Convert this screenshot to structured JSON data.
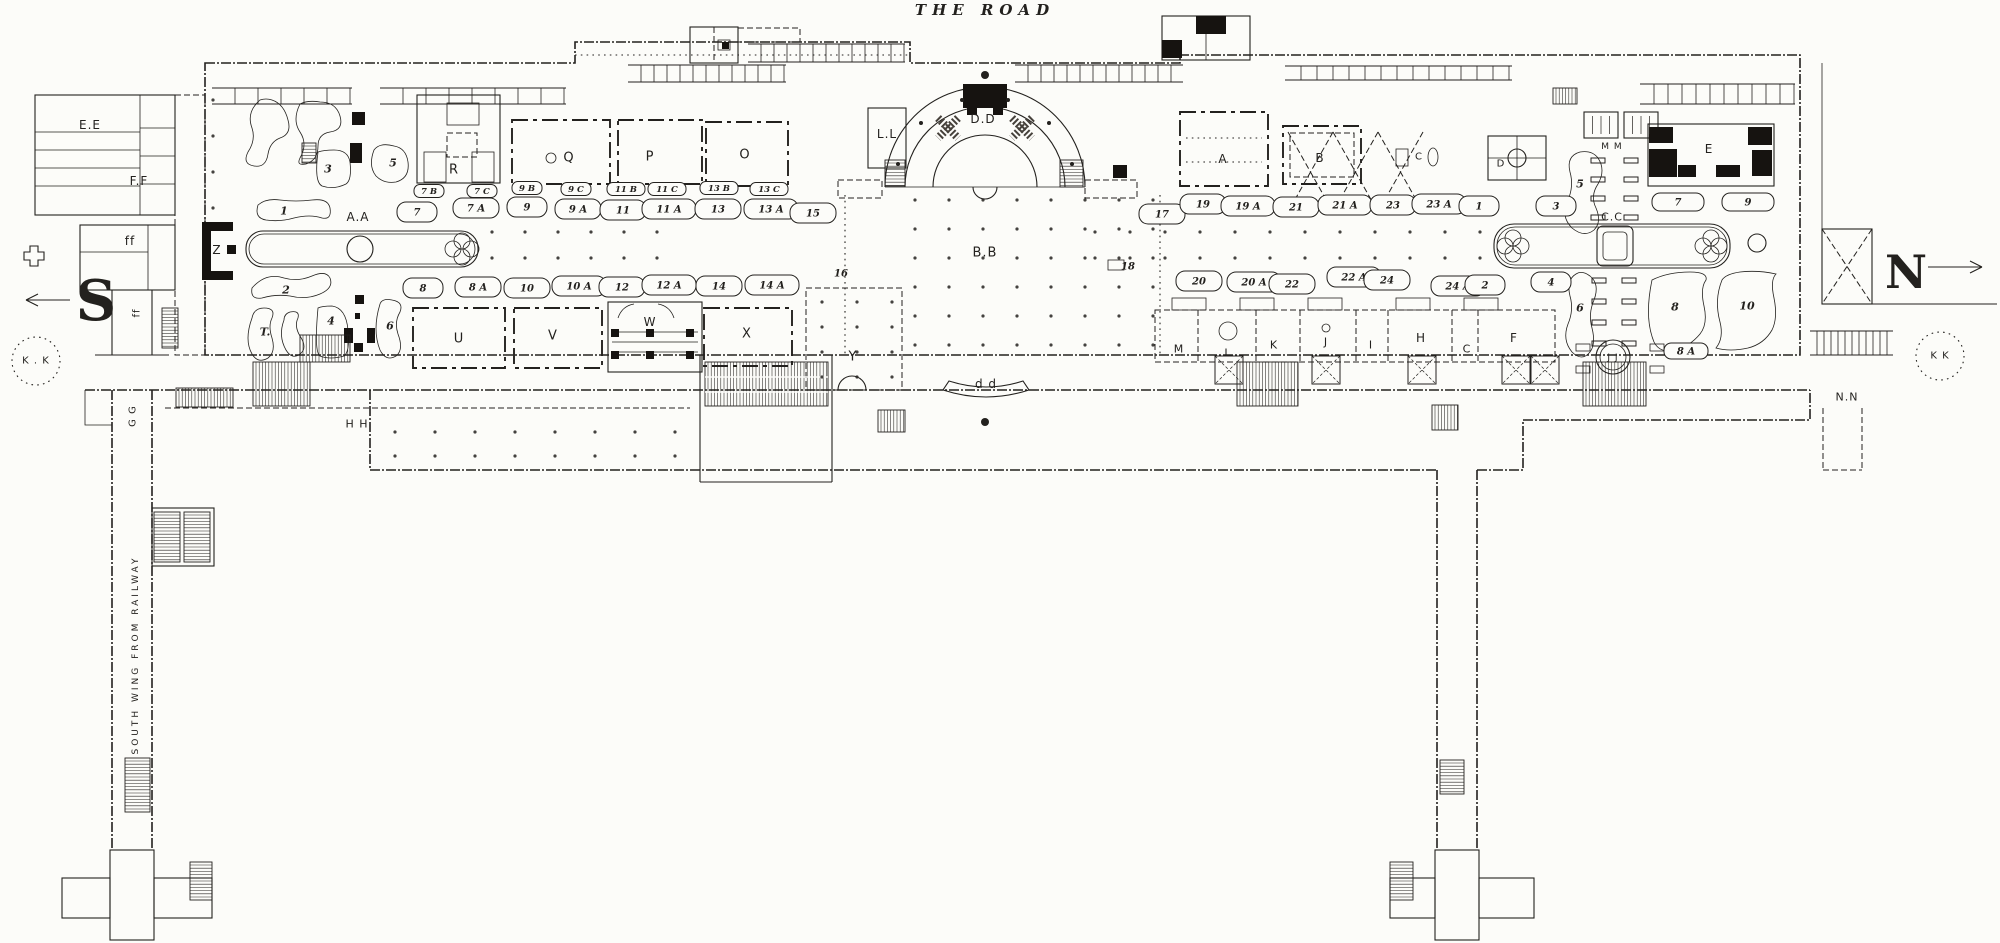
{
  "colors": {
    "paper": "#fcfcf9",
    "ink": "#23211e"
  },
  "plan_labels": [
    {
      "id": "road-title",
      "t": "THE ROAD",
      "x": 985,
      "y": 10,
      "fs": 15,
      "cls": "title"
    },
    {
      "id": "south-s",
      "t": "S",
      "x": 96,
      "y": 301,
      "fs": 56,
      "cls": "big"
    },
    {
      "id": "north-n",
      "t": "N",
      "x": 1906,
      "y": 272,
      "fs": 46,
      "cls": "big"
    },
    {
      "id": "ee",
      "t": "E.E",
      "x": 90,
      "y": 125,
      "fs": 12,
      "cls": "sans"
    },
    {
      "id": "ff-upper",
      "t": "F.F",
      "x": 139,
      "y": 181,
      "fs": 12,
      "cls": "sans"
    },
    {
      "id": "ff-lower",
      "t": "ff",
      "x": 130,
      "y": 241,
      "fs": 12,
      "cls": "sans"
    },
    {
      "id": "ff-wing",
      "t": "ff",
      "x": 137,
      "y": 313,
      "fs": 10,
      "cls": "sans",
      "rot": -90
    },
    {
      "id": "z",
      "t": "Z",
      "x": 217,
      "y": 250,
      "fs": 12,
      "cls": "sans"
    },
    {
      "id": "aa-basin",
      "t": "A.A",
      "x": 358,
      "y": 217,
      "fs": 12,
      "cls": "sans"
    },
    {
      "id": "court-r",
      "t": "R",
      "x": 454,
      "y": 170,
      "fs": 13,
      "cls": "sans"
    },
    {
      "id": "court-q",
      "t": "Q",
      "x": 569,
      "y": 158,
      "fs": 13,
      "cls": "sans"
    },
    {
      "id": "court-p",
      "t": "P",
      "x": 650,
      "y": 157,
      "fs": 13,
      "cls": "sans"
    },
    {
      "id": "court-o",
      "t": "O",
      "x": 745,
      "y": 155,
      "fs": 13,
      "cls": "sans"
    },
    {
      "id": "ll",
      "t": "L.L",
      "x": 887,
      "y": 134,
      "fs": 12,
      "cls": "sans"
    },
    {
      "id": "dd-orchestra",
      "t": "D.D",
      "x": 983,
      "y": 119,
      "fs": 12,
      "cls": "sans"
    },
    {
      "id": "bb",
      "t": "B.B",
      "x": 985,
      "y": 253,
      "fs": 13,
      "cls": "sans"
    },
    {
      "id": "court-u",
      "t": "U",
      "x": 459,
      "y": 339,
      "fs": 13,
      "cls": "sans"
    },
    {
      "id": "court-v",
      "t": "V",
      "x": 553,
      "y": 336,
      "fs": 13,
      "cls": "sans"
    },
    {
      "id": "court-w",
      "t": "W",
      "x": 650,
      "y": 322,
      "fs": 12,
      "cls": "sans"
    },
    {
      "id": "court-x",
      "t": "X",
      "x": 747,
      "y": 334,
      "fs": 13,
      "cls": "sans"
    },
    {
      "id": "court-y",
      "t": "Y",
      "x": 853,
      "y": 357,
      "fs": 13,
      "cls": "sans"
    },
    {
      "id": "dd-screen",
      "t": "d d",
      "x": 986,
      "y": 384,
      "fs": 12,
      "cls": "sans"
    },
    {
      "id": "court-a",
      "t": "A",
      "x": 1223,
      "y": 159,
      "fs": 12,
      "cls": "sans"
    },
    {
      "id": "court-b",
      "t": "B",
      "x": 1320,
      "y": 158,
      "fs": 12,
      "cls": "sans"
    },
    {
      "id": "court-c-upper",
      "t": "C",
      "x": 1419,
      "y": 157,
      "fs": 10,
      "cls": "sans"
    },
    {
      "id": "court-d",
      "t": "D",
      "x": 1501,
      "y": 164,
      "fs": 10,
      "cls": "sans"
    },
    {
      "id": "court-e",
      "t": "E",
      "x": 1709,
      "y": 149,
      "fs": 12,
      "cls": "sans"
    },
    {
      "id": "mm",
      "t": "M M",
      "x": 1612,
      "y": 147,
      "fs": 9,
      "cls": "sans"
    },
    {
      "id": "cc-basin",
      "t": "C.C",
      "x": 1612,
      "y": 217,
      "fs": 11,
      "cls": "sans"
    },
    {
      "id": "court-m",
      "t": "M",
      "x": 1179,
      "y": 349,
      "fs": 11,
      "cls": "sans"
    },
    {
      "id": "court-l",
      "t": "L",
      "x": 1228,
      "y": 353,
      "fs": 11,
      "cls": "sans"
    },
    {
      "id": "court-k",
      "t": "K",
      "x": 1274,
      "y": 345,
      "fs": 11,
      "cls": "sans"
    },
    {
      "id": "court-j",
      "t": "J",
      "x": 1326,
      "y": 342,
      "fs": 11,
      "cls": "sans"
    },
    {
      "id": "court-i",
      "t": "I",
      "x": 1371,
      "y": 345,
      "fs": 11,
      "cls": "sans"
    },
    {
      "id": "court-h",
      "t": "H",
      "x": 1421,
      "y": 338,
      "fs": 12,
      "cls": "sans"
    },
    {
      "id": "court-c-lower",
      "t": "C",
      "x": 1467,
      "y": 349,
      "fs": 11,
      "cls": "sans"
    },
    {
      "id": "court-f",
      "t": "F",
      "x": 1514,
      "y": 338,
      "fs": 12,
      "cls": "sans"
    },
    {
      "id": "jj",
      "t": "J J",
      "x": 1613,
      "y": 358,
      "fs": 9,
      "cls": "sans"
    },
    {
      "id": "nn",
      "t": "N.N",
      "x": 1847,
      "y": 397,
      "fs": 11,
      "cls": "sans"
    },
    {
      "id": "kk-left",
      "t": "K . K",
      "x": 36,
      "y": 361,
      "fs": 10,
      "cls": "sans"
    },
    {
      "id": "kk-right",
      "t": "K K",
      "x": 1940,
      "y": 356,
      "fs": 10,
      "cls": "sans"
    },
    {
      "id": "hh",
      "t": "H H",
      "x": 357,
      "y": 424,
      "fs": 11,
      "cls": "sans"
    },
    {
      "id": "gg",
      "t": "G G",
      "x": 133,
      "y": 416,
      "fs": 10,
      "cls": "sans",
      "rot": -90
    },
    {
      "id": "t-garden",
      "t": "T.",
      "x": 265,
      "y": 332,
      "fs": 11,
      "cls": "num"
    },
    {
      "id": "wing-text",
      "t": "SOUTH WING FROM RAILWAY",
      "x": 136,
      "y": 655,
      "fs": 9,
      "cls": "wing",
      "rot": -90
    },
    {
      "id": "g1",
      "t": "1",
      "x": 284,
      "y": 211,
      "fs": 11,
      "cls": "num"
    },
    {
      "id": "g2",
      "t": "2",
      "x": 286,
      "y": 290,
      "fs": 11,
      "cls": "num"
    },
    {
      "id": "g3",
      "t": "3",
      "x": 328,
      "y": 169,
      "fs": 11,
      "cls": "num"
    },
    {
      "id": "g4",
      "t": "4",
      "x": 331,
      "y": 321,
      "fs": 11,
      "cls": "num"
    },
    {
      "id": "g5",
      "t": "5",
      "x": 393,
      "y": 163,
      "fs": 11,
      "cls": "num"
    },
    {
      "id": "g6",
      "t": "6",
      "x": 390,
      "y": 326,
      "fs": 11,
      "cls": "num"
    },
    {
      "id": "n7",
      "t": "7",
      "x": 417,
      "y": 213,
      "fs": 10,
      "cls": "num",
      "blob": 1
    },
    {
      "id": "n7a",
      "t": "7 A",
      "x": 476,
      "y": 209,
      "fs": 10,
      "cls": "num",
      "blob": 1
    },
    {
      "id": "n9",
      "t": "9",
      "x": 527,
      "y": 208,
      "fs": 10,
      "cls": "num",
      "blob": 1
    },
    {
      "id": "n9a",
      "t": "9 A",
      "x": 578,
      "y": 210,
      "fs": 10,
      "cls": "num",
      "blob": 1
    },
    {
      "id": "n11",
      "t": "11",
      "x": 623,
      "y": 211,
      "fs": 10,
      "cls": "num",
      "blob": 1
    },
    {
      "id": "n11a",
      "t": "11 A",
      "x": 669,
      "y": 210,
      "fs": 10,
      "cls": "num",
      "blob": 1
    },
    {
      "id": "n13",
      "t": "13",
      "x": 718,
      "y": 210,
      "fs": 10,
      "cls": "num",
      "blob": 1
    },
    {
      "id": "n13a",
      "t": "13 A",
      "x": 771,
      "y": 210,
      "fs": 10,
      "cls": "num",
      "blob": 1
    },
    {
      "id": "n15",
      "t": "15",
      "x": 813,
      "y": 214,
      "fs": 10,
      "cls": "num",
      "blob": 1
    },
    {
      "id": "n17",
      "t": "17",
      "x": 1162,
      "y": 215,
      "fs": 10,
      "cls": "num",
      "blob": 1
    },
    {
      "id": "n19",
      "t": "19",
      "x": 1203,
      "y": 205,
      "fs": 10,
      "cls": "num",
      "blob": 1
    },
    {
      "id": "n19a",
      "t": "19 A",
      "x": 1248,
      "y": 207,
      "fs": 10,
      "cls": "num",
      "blob": 1
    },
    {
      "id": "n21",
      "t": "21",
      "x": 1296,
      "y": 208,
      "fs": 10,
      "cls": "num",
      "blob": 1
    },
    {
      "id": "n21a",
      "t": "21 A",
      "x": 1345,
      "y": 206,
      "fs": 10,
      "cls": "num",
      "blob": 1
    },
    {
      "id": "n23",
      "t": "23",
      "x": 1393,
      "y": 206,
      "fs": 10,
      "cls": "num",
      "blob": 1
    },
    {
      "id": "n23a",
      "t": "23 A",
      "x": 1439,
      "y": 205,
      "fs": 10,
      "cls": "num",
      "blob": 1
    },
    {
      "id": "n1",
      "t": "1",
      "x": 1479,
      "y": 207,
      "fs": 10,
      "cls": "num",
      "blob": 1
    },
    {
      "id": "n3",
      "t": "3",
      "x": 1556,
      "y": 207,
      "fs": 10,
      "cls": "num",
      "blob": 1
    },
    {
      "id": "s7b",
      "t": "7 B",
      "x": 429,
      "y": 192,
      "fs": 8.5,
      "cls": "sub",
      "blob": 1
    },
    {
      "id": "s7c",
      "t": "7 C",
      "x": 482,
      "y": 192,
      "fs": 8.5,
      "cls": "sub",
      "blob": 1
    },
    {
      "id": "s9b",
      "t": "9 B",
      "x": 527,
      "y": 189,
      "fs": 8.5,
      "cls": "sub",
      "blob": 1
    },
    {
      "id": "s9c",
      "t": "9 C",
      "x": 576,
      "y": 190,
      "fs": 8.5,
      "cls": "sub",
      "blob": 1
    },
    {
      "id": "s11b",
      "t": "11 B",
      "x": 626,
      "y": 190,
      "fs": 8.5,
      "cls": "sub",
      "blob": 1
    },
    {
      "id": "s11c",
      "t": "11 C",
      "x": 667,
      "y": 190,
      "fs": 8.5,
      "cls": "sub",
      "blob": 1
    },
    {
      "id": "s13b",
      "t": "13 B",
      "x": 719,
      "y": 189,
      "fs": 8.5,
      "cls": "sub",
      "blob": 1
    },
    {
      "id": "s13c",
      "t": "13 C",
      "x": 769,
      "y": 190,
      "fs": 8.5,
      "cls": "sub",
      "blob": 1
    },
    {
      "id": "n8",
      "t": "8",
      "x": 423,
      "y": 289,
      "fs": 10,
      "cls": "num",
      "blob": 1
    },
    {
      "id": "n8a",
      "t": "8 A",
      "x": 478,
      "y": 288,
      "fs": 10,
      "cls": "num",
      "blob": 1
    },
    {
      "id": "n10",
      "t": "10",
      "x": 527,
      "y": 289,
      "fs": 10,
      "cls": "num",
      "blob": 1
    },
    {
      "id": "n10a",
      "t": "10 A",
      "x": 579,
      "y": 287,
      "fs": 10,
      "cls": "num",
      "blob": 1
    },
    {
      "id": "n12",
      "t": "12",
      "x": 622,
      "y": 288,
      "fs": 10,
      "cls": "num",
      "blob": 1
    },
    {
      "id": "n12a",
      "t": "12 A",
      "x": 669,
      "y": 286,
      "fs": 10,
      "cls": "num",
      "blob": 1
    },
    {
      "id": "n14",
      "t": "14",
      "x": 719,
      "y": 287,
      "fs": 10,
      "cls": "num",
      "blob": 1
    },
    {
      "id": "n14a",
      "t": "14 A",
      "x": 772,
      "y": 286,
      "fs": 10,
      "cls": "num",
      "blob": 1
    },
    {
      "id": "n16",
      "t": "16",
      "x": 841,
      "y": 274,
      "fs": 10,
      "cls": "num"
    },
    {
      "id": "n18",
      "t": "18",
      "x": 1128,
      "y": 267,
      "fs": 10,
      "cls": "num"
    },
    {
      "id": "n20",
      "t": "20",
      "x": 1199,
      "y": 282,
      "fs": 10,
      "cls": "num",
      "blob": 1
    },
    {
      "id": "n20a",
      "t": "20 A",
      "x": 1254,
      "y": 283,
      "fs": 10,
      "cls": "num",
      "blob": 1
    },
    {
      "id": "n22",
      "t": "22",
      "x": 1292,
      "y": 285,
      "fs": 10,
      "cls": "num",
      "blob": 1
    },
    {
      "id": "n22a",
      "t": "22 A",
      "x": 1354,
      "y": 278,
      "fs": 10,
      "cls": "num",
      "blob": 1
    },
    {
      "id": "n24",
      "t": "24",
      "x": 1387,
      "y": 281,
      "fs": 10,
      "cls": "num",
      "blob": 1
    },
    {
      "id": "n24a",
      "t": "24 A",
      "x": 1458,
      "y": 287,
      "fs": 10,
      "cls": "num",
      "blob": 1
    },
    {
      "id": "n2",
      "t": "2",
      "x": 1485,
      "y": 286,
      "fs": 10,
      "cls": "num",
      "blob": 1
    },
    {
      "id": "n4",
      "t": "4",
      "x": 1551,
      "y": 283,
      "fs": 10,
      "cls": "num",
      "blob": 1
    },
    {
      "id": "r5",
      "t": "5",
      "x": 1580,
      "y": 184,
      "fs": 11,
      "cls": "num"
    },
    {
      "id": "r6",
      "t": "6",
      "x": 1580,
      "y": 308,
      "fs": 11,
      "cls": "num"
    },
    {
      "id": "r7",
      "t": "7",
      "x": 1678,
      "y": 203,
      "fs": 10,
      "cls": "num",
      "blob": 1,
      "bw": 52,
      "bh": 18
    },
    {
      "id": "r9",
      "t": "9",
      "x": 1748,
      "y": 203,
      "fs": 10,
      "cls": "num",
      "blob": 1,
      "bw": 52,
      "bh": 18
    },
    {
      "id": "r8",
      "t": "8",
      "x": 1675,
      "y": 307,
      "fs": 11,
      "cls": "num"
    },
    {
      "id": "r10",
      "t": "10",
      "x": 1747,
      "y": 306,
      "fs": 11,
      "cls": "num"
    },
    {
      "id": "r8a",
      "t": "8 A",
      "x": 1686,
      "y": 352,
      "fs": 10,
      "cls": "num",
      "blob": 1,
      "bw": 44,
      "bh": 16
    }
  ]
}
